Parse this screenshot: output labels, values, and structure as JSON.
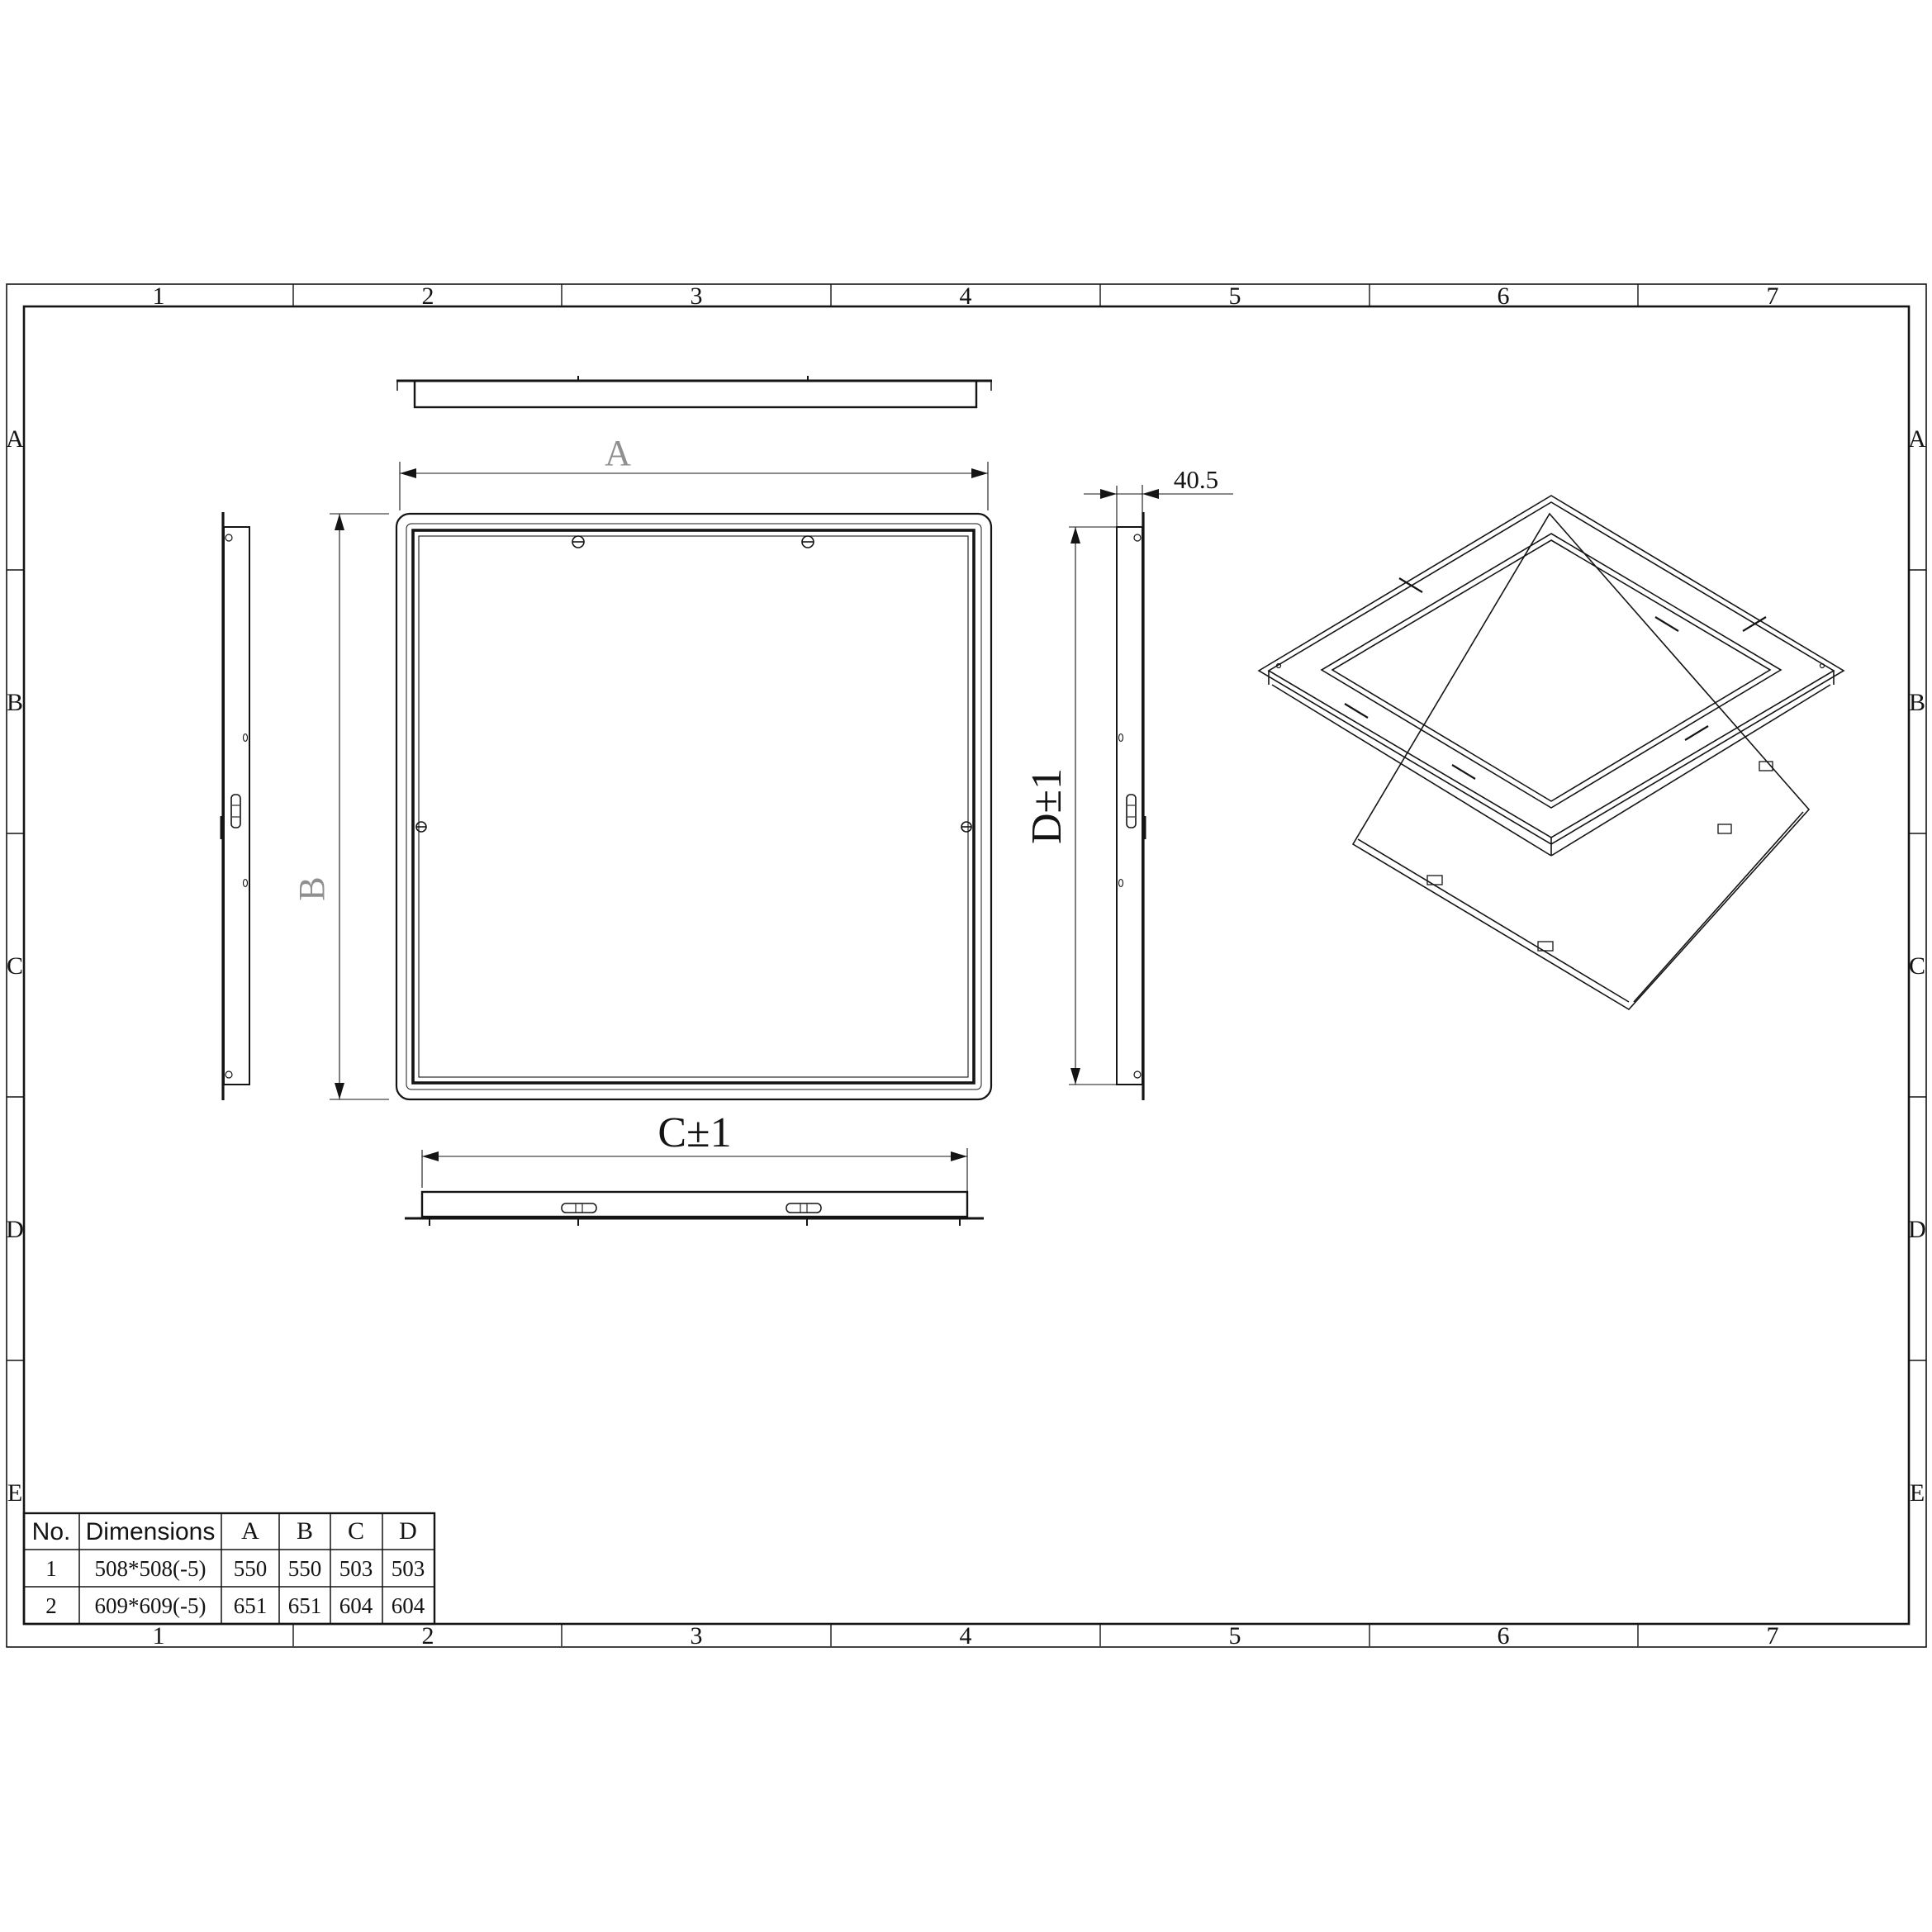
{
  "sheet": {
    "zone_columns": [
      "1",
      "2",
      "3",
      "4",
      "5",
      "6",
      "7"
    ],
    "zone_rows": [
      "A",
      "B",
      "C",
      "D",
      "E"
    ]
  },
  "dimensions": {
    "width": "A",
    "height": "B",
    "inner_width": "C±1",
    "inner_height": "D±1",
    "flange_depth": "40.5"
  },
  "table": {
    "headers": [
      "No.",
      "Dimensions",
      "A",
      "B",
      "C",
      "D"
    ],
    "rows": [
      [
        "1",
        "508*508(-5)",
        "550",
        "550",
        "503",
        "503"
      ],
      [
        "2",
        "609*609(-5)",
        "651",
        "651",
        "604",
        "604"
      ]
    ]
  }
}
